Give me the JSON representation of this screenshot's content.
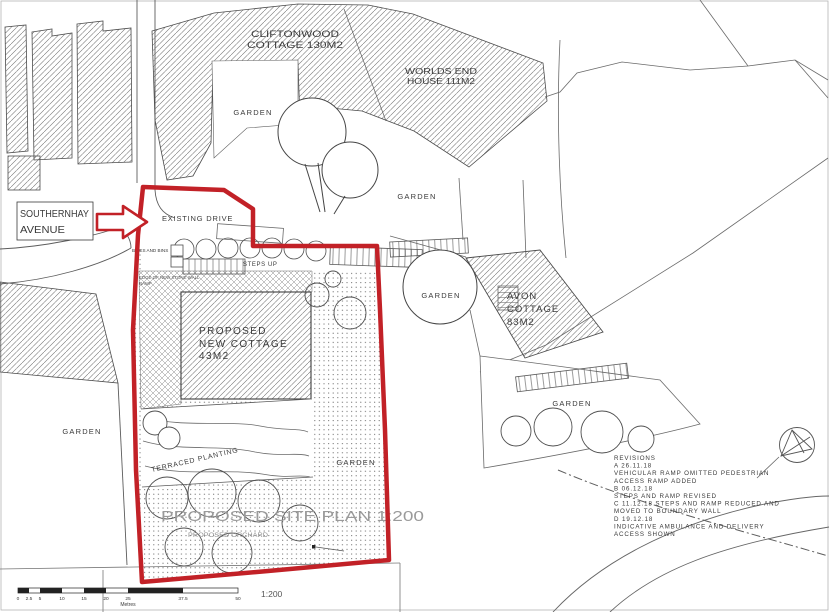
{
  "title": {
    "text": "PROPOSED SITE PLAN 1:200"
  },
  "labels": {
    "cliftonwood_line1": "CLIFTONWOOD",
    "cliftonwood_line2": "COTTAGE 130M2",
    "worlds_end_line1": "WORLDS END",
    "worlds_end_line2": "HOUSE 111M2",
    "garden": "GARDEN",
    "southernhay_line1": "SOUTHERNHAY",
    "southernhay_line2": "AVENUE",
    "existing_drive": "EXISTING DRIVE",
    "bikes_and_bins": "BIKES AND BINS",
    "steps_up": "STEPS UP",
    "stone_wall_line1": "EDGE OF NEW STONE WALL",
    "stone_wall_line2": "RAMP",
    "proposed_cottage_line1": "PROPOSED",
    "proposed_cottage_line2": "NEW COTTAGE",
    "proposed_cottage_line3": "43M2",
    "avon_line1": "AVON",
    "avon_line2": "COTTAGE",
    "avon_line3": "83M2",
    "terraced_planting": "TERRACED PLANTING",
    "proposed_orchard": "PROPOSED ORCHARD"
  },
  "revisions": {
    "lines": [
      "REVISIONS",
      "A 26.11.18",
      "VEHICULAR RAMP OMITTED PEDESTRIAN",
      "ACCESS RAMP ADDED",
      "B 06.12.18",
      "STEPS AND RAMP REVISED",
      "C 11.12.18 STEPS AND RAMP REDUCED AND",
      "MOVED TO BOUNDARY WALL",
      "D 19.12.18",
      "INDICATIVE AMBULANCE AND DELIVERY",
      "ACCESS SHOWN"
    ]
  },
  "scale_bar": {
    "ticks": [
      "0",
      "2.5",
      "5",
      "10",
      "15",
      "20",
      "25",
      "37.5",
      "50"
    ],
    "units": "Metres",
    "ratio": "1:200"
  },
  "colors": {
    "boundary_red": "#c22127",
    "title_gray": "#9a9a9a",
    "ink": "#3a3a3a"
  }
}
